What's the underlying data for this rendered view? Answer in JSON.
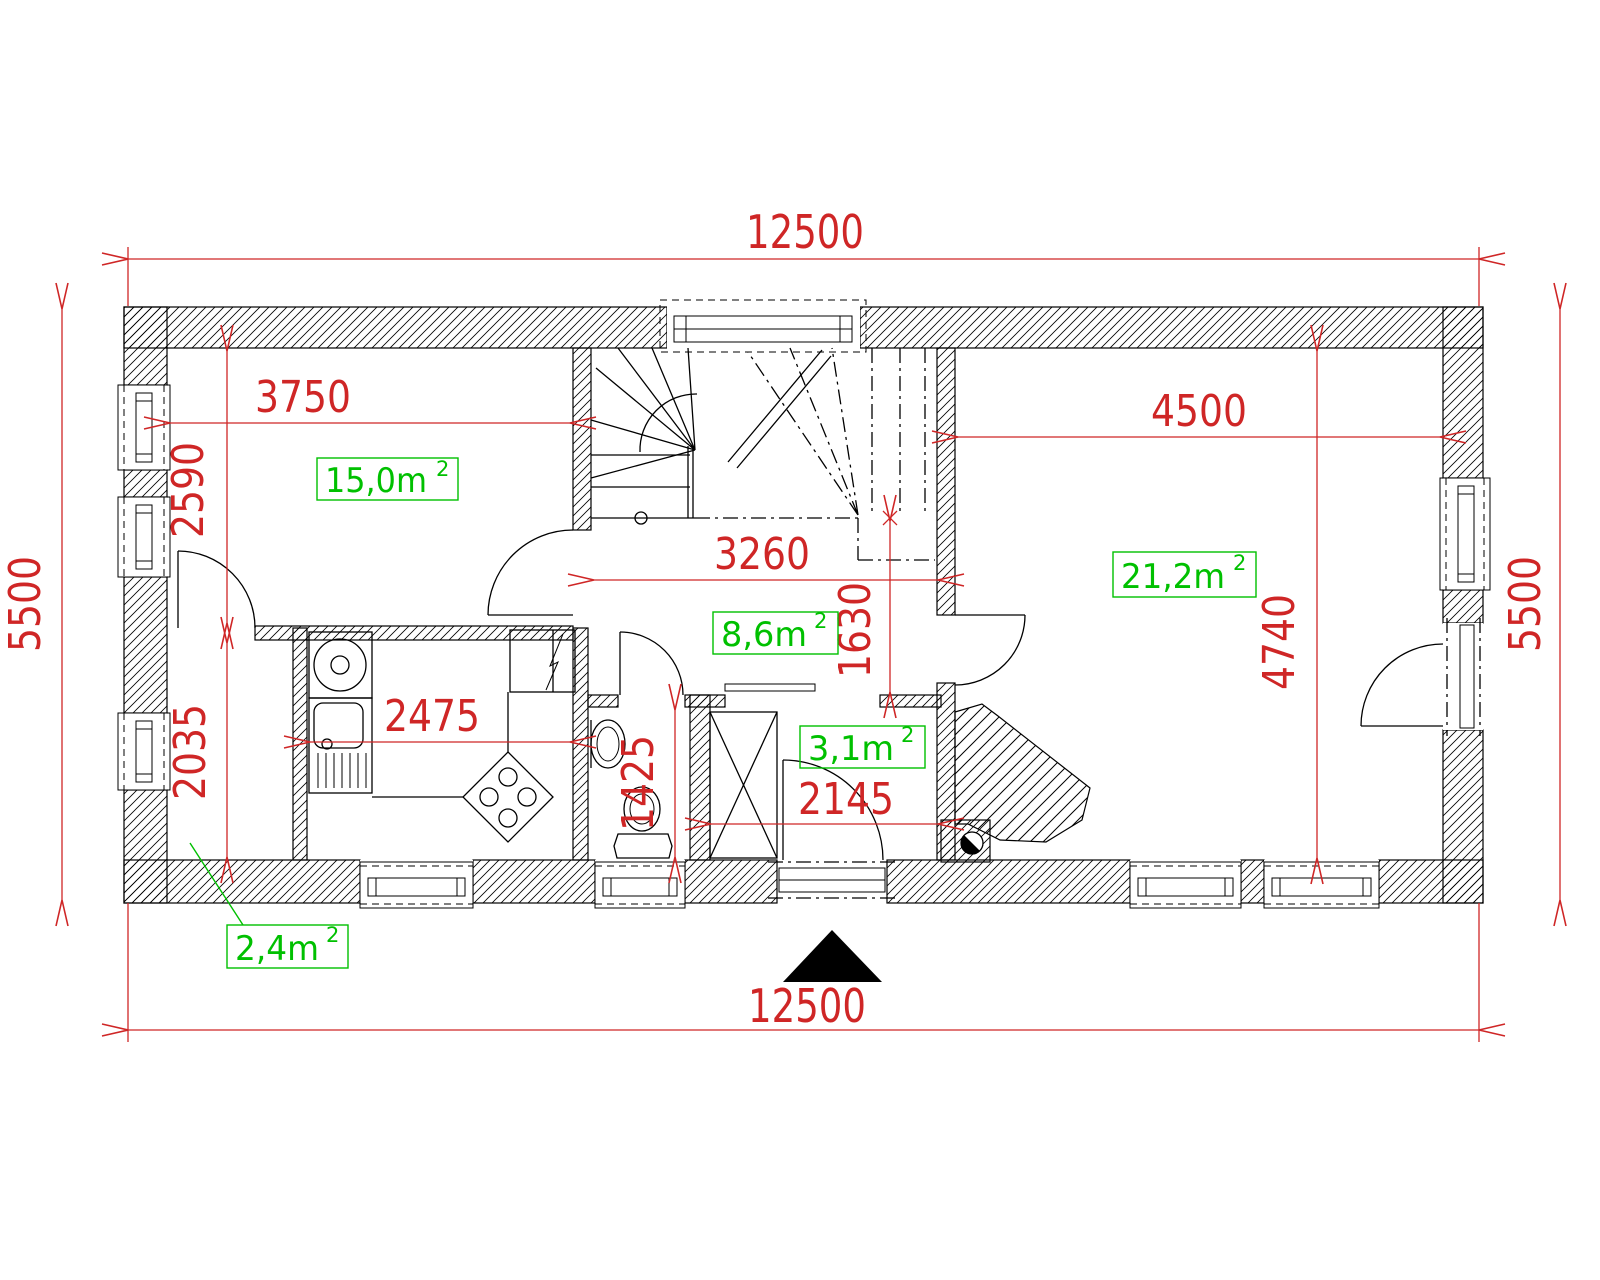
{
  "drawing_type": "floor-plan",
  "colors": {
    "dimension_red": "#cf2626",
    "area_green": "#00c000",
    "line_black": "#000000",
    "background": "#ffffff"
  },
  "dimensions": {
    "overall_top": "12500",
    "overall_bottom": "12500",
    "overall_left": "5500",
    "overall_right": "5500",
    "living_width": "3750",
    "living_height": "2590",
    "room2_width": "4500",
    "room2_height": "4740",
    "hall_width": "3260",
    "hall_height": "1630",
    "kitchen_width": "2475",
    "entry_height": "2035",
    "bath_height": "1425",
    "vestibule_width": "2145"
  },
  "area_labels": {
    "living": {
      "text": "15,0m",
      "sup": "2"
    },
    "room2": {
      "text": "21,2m",
      "sup": "2"
    },
    "hall": {
      "text": "8,6m",
      "sup": "2"
    },
    "vestibule": {
      "text": "3,1m",
      "sup": "2"
    },
    "entry": {
      "text": "2,4m",
      "sup": "2"
    }
  }
}
